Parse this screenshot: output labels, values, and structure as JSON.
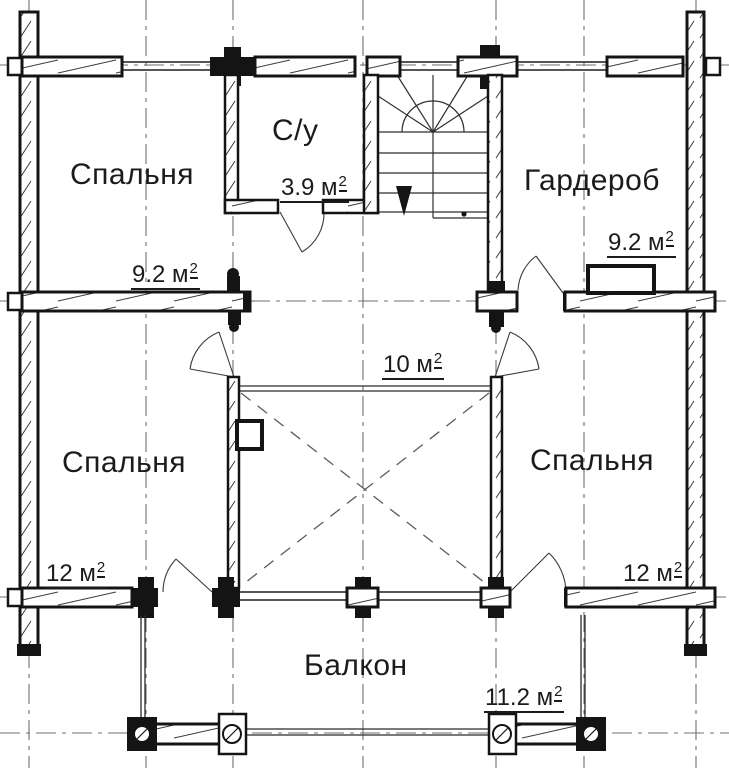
{
  "plan": {
    "kind": "second-floor plan of a log house",
    "colors": {
      "ink": "#141414",
      "paper": "#ffffff",
      "axis": "#6e6e6e"
    },
    "rooms": [
      {
        "id": "bedroom-top-left",
        "name": "Спальня",
        "area_text": "9.2 м",
        "area_sup": "2"
      },
      {
        "id": "bathroom",
        "name": "С/у",
        "area_text": "3.9 м",
        "area_sup": "2"
      },
      {
        "id": "wardrobe",
        "name": "Гардероб",
        "area_text": "9.2 м",
        "area_sup": "2"
      },
      {
        "id": "hall",
        "name": "",
        "area_text": "10 м",
        "area_sup": "2"
      },
      {
        "id": "bedroom-bottom-left",
        "name": "Спальня",
        "area_text": "12 м",
        "area_sup": "2"
      },
      {
        "id": "bedroom-bottom-right",
        "name": "Спальня",
        "area_text": "12 м",
        "area_sup": "2"
      },
      {
        "id": "balcony",
        "name": "Балкон",
        "area_text": "11.2 м",
        "area_sup": "2"
      }
    ]
  }
}
